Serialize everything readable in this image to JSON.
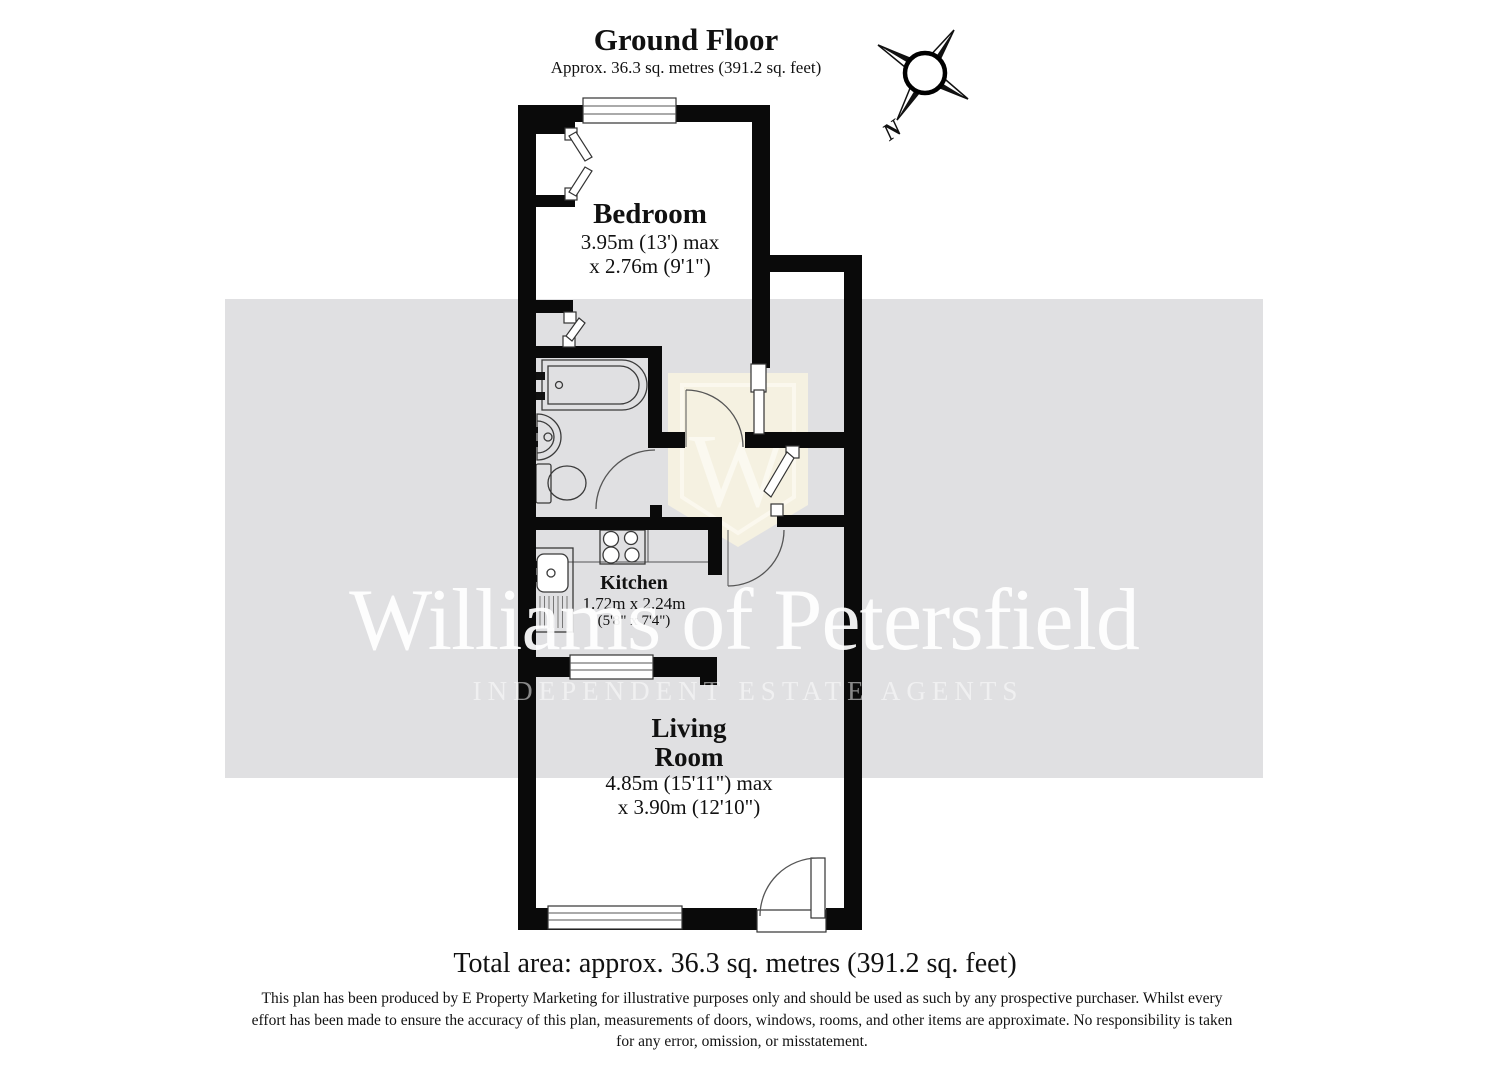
{
  "header": {
    "title": "Ground Floor",
    "subtitle": "Approx. 36.3 sq. metres (391.2 sq. feet)"
  },
  "compass": {
    "north_label": "N"
  },
  "rooms": {
    "bedroom": {
      "name": "Bedroom",
      "dim_metric": "3.95m (13') max",
      "dim_imperial": "x 2.76m (9'1\")"
    },
    "kitchen": {
      "name": "Kitchen",
      "dim_metric": "1.72m x 2.24m",
      "dim_imperial": "(5'8\" x 7'4\")"
    },
    "living_room": {
      "name_line1": "Living",
      "name_line2": "Room",
      "dim_metric": "4.85m (15'11\") max",
      "dim_imperial": "x 3.90m (12'10\")"
    }
  },
  "watermark": {
    "brand": "Williams of Petersfield",
    "tagline": "INDEPENDENT ESTATE AGENTS",
    "monogram": "W"
  },
  "footer": {
    "total_area": "Total area: approx. 36.3 sq. metres (391.2 sq. feet)",
    "disclaimer": "This plan has been produced by E Property Marketing for illustrative purposes only and should be used as such by any prospective purchaser. Whilst every effort has been made to ensure the accuracy of this plan, measurements of doors, windows, rooms, and other items are approximate. No responsibility is taken for any error, omission, or misstatement."
  },
  "colors": {
    "band": "#e0e0e2",
    "wall": "#0a0a0a",
    "shield": "#f5f1e1"
  }
}
